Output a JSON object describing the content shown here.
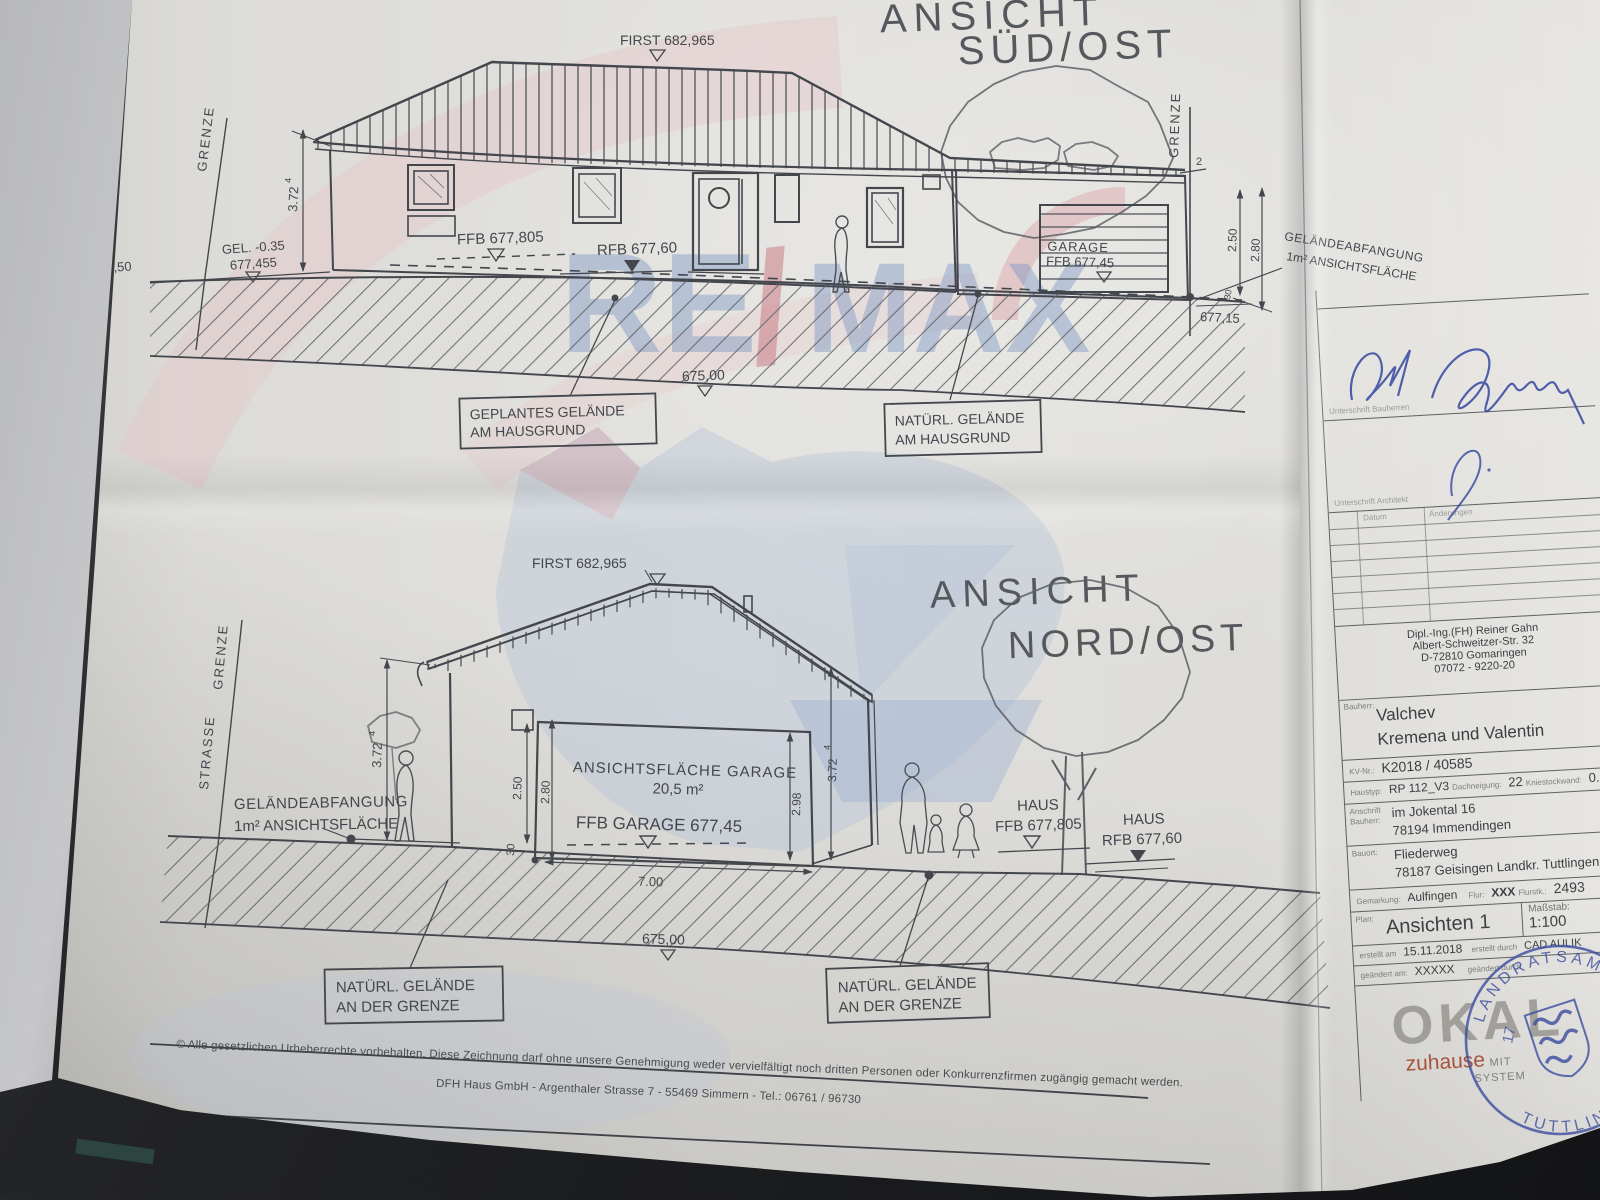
{
  "watermark": {
    "re": "RE",
    "slash": "/",
    "max": "MAX"
  },
  "vt": {
    "ansicht": "ANSICHT",
    "richtung": "SÜD/OST",
    "first": "FIRST 682,965",
    "grenze_l": "GRENZE",
    "lvl_67750": "677,50",
    "gel": "GEL. -0.35",
    "gel2": "677,455",
    "d372": "3.72",
    "sup": "4",
    "ffb": "FFB 677,805",
    "rfb": "RFB 677,60",
    "garage1": "GARAGE",
    "garage2": "FFB 677,45",
    "grenze_r": "GRENZE",
    "d2": "2",
    "d250": "2.50",
    "d280": "2.80",
    "d30": "30",
    "lvl_67715": "677,15",
    "note1": "GELÄNDEABFANGUNG",
    "note2": "1m² ANSICHTSFLÄCHE",
    "lvl_675": "675,00",
    "co1a": "GEPLANTES GELÄNDE",
    "co1b": "AM HAUSGRUND",
    "co2a": "NATÜRL. GELÄNDE",
    "co2b": "AM HAUSGRUND"
  },
  "vb": {
    "ansicht": "ANSICHT",
    "richtung": "NORD/OST",
    "first": "FIRST 682,965",
    "strasse": "STRASSE",
    "grenze": "GRENZE",
    "d372l": "3.72",
    "sup": "4",
    "note1": "GELÄNDEABFANGUNG",
    "note2": "1m² ANSICHTSFLÄCHE",
    "area1": "ANSICHTSFLÄCHE GARAGE",
    "area2": "20,5 m²",
    "ffbg": "FFB GARAGE 677,45",
    "d250": "2.50",
    "d280": "2.80",
    "d30": "30",
    "d298": "2.98",
    "d372r": "3.72",
    "d700": "7.00",
    "haus1": "HAUS",
    "ffb": "FFB 677,805",
    "haus2": "HAUS",
    "rfb": "RFB 677,60",
    "lvl_675": "675,00",
    "co1a": "NATÜRL. GELÄNDE",
    "co1b": "AN DER GRENZE",
    "co2a": "NATÜRL. GELÄNDE",
    "co2b": "AN DER GRENZE"
  },
  "tb": {
    "sig1_label": "Unterschrift Bauherren",
    "sig2_label": "Unterschrift Architekt",
    "rev_datum": "Datum",
    "rev_aender": "Änderungen",
    "arch1": "Dipl.-Ing.(FH) Reiner Gahn",
    "arch2": "Albert-Schweitzer-Str. 32",
    "arch3": "D-72810 Gomaringen",
    "arch4": "07072 - 9220-20",
    "bauherr_label": "Bauherr:",
    "name1": "Valchev",
    "name2": "Kremena und Valentin",
    "kv_label": "KV-Nr.:",
    "kv": "K2018 / 40585",
    "haustyp_label": "Haustyp:",
    "haustyp": "RP 112_V3",
    "dach_label": "Dachneigung:",
    "dach": "22",
    "knie_label": "Kniestockwand:",
    "knie": "0.04",
    "anschrift_label1": "Anschrift",
    "anschrift_label2": "Bauherr:",
    "anschrift1": "im Jokental 16",
    "anschrift2": "78194 Immendingen",
    "bauort_label": "Bauort:",
    "bauort1": "Fliederweg",
    "bauort2": "78187 Geisingen Landkr. Tuttlingen",
    "gem_label": "Gemarkung:",
    "gem": "Aulfingen",
    "flur_label": "Flur:",
    "flur": "XXX",
    "flurstk_label": "Flurstk.:",
    "flurstk": "2493",
    "plan_label": "Plan:",
    "plan": "Ansichten 1",
    "mass_label": "Maßstab:",
    "mass": "1:100",
    "erst_am_label": "erstellt am",
    "erst_am": "15.11.2018",
    "erst_durch_label": "erstellt durch",
    "erst_durch": "CAD AULIK",
    "geaen_am_label": "geändert am:",
    "geaen_am": "XXXXX",
    "geaen_durch_label": "geändert durch",
    "okal": "OKAL",
    "tag1": "zuhause",
    "tag2": "MIT",
    "tag3": "SYSTEM",
    "stamp_top": "LANDRATSAMT",
    "stamp_bottom": "TUTTLINGEN",
    "stamp_no": "17"
  },
  "footer": {
    "line1": "© Alle gesetzlichen Urheberrechte vorbehalten. Diese Zeichnung darf ohne unsere Genehmigung weder vervielfältigt noch dritten Personen oder Konkurrenzfirmen zugängig gemacht werden.",
    "line2": "DFH Haus GmbH - Argenthaler Strasse 7 - 55469 Simmern - Tel.: 06761 / 96730"
  }
}
